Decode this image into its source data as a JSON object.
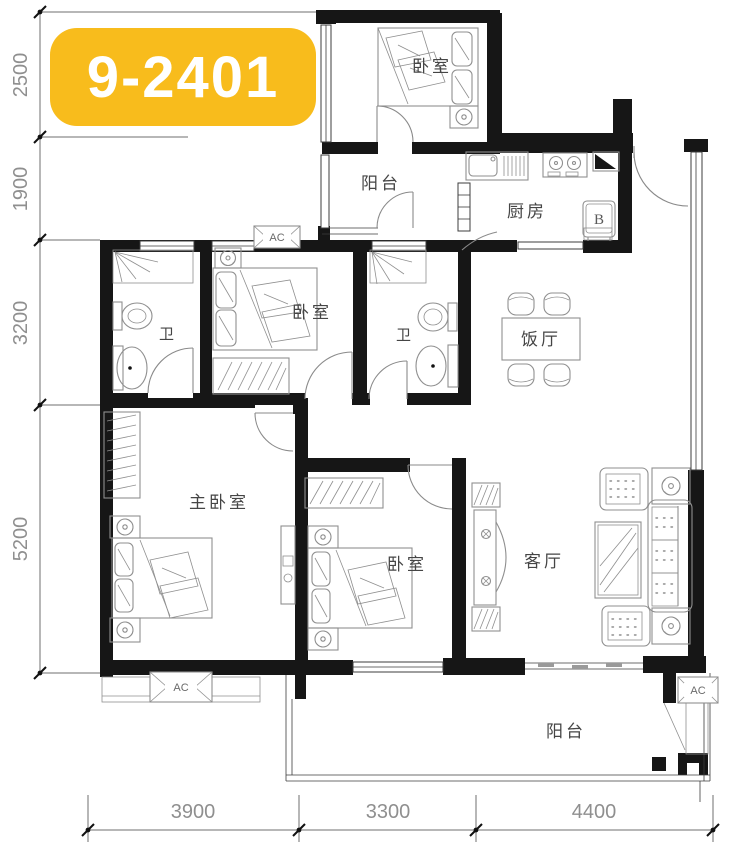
{
  "badge": {
    "label": "9-2401"
  },
  "dimensions": {
    "left": [
      {
        "label": "2500"
      },
      {
        "label": "1900"
      },
      {
        "label": "3200"
      },
      {
        "label": "5200"
      }
    ],
    "bottom": [
      {
        "label": "3900"
      },
      {
        "label": "3300"
      },
      {
        "label": "4400"
      }
    ]
  },
  "rooms": {
    "bedroom_top": {
      "label": "卧室"
    },
    "balcony_top": {
      "label": "阳台"
    },
    "kitchen": {
      "label": "厨房"
    },
    "bath_left": {
      "label": "卫"
    },
    "bedroom_mid": {
      "label": "卧室"
    },
    "bath_right": {
      "label": "卫"
    },
    "dining": {
      "label": "饭厅"
    },
    "master_bedroom": {
      "label": "主卧室"
    },
    "bedroom_lower": {
      "label": "卧室"
    },
    "living": {
      "label": "客厅"
    },
    "balcony_bottom": {
      "label": "阳台"
    }
  },
  "markers": {
    "ac_top": {
      "label": "AC"
    },
    "ac_master": {
      "label": "AC"
    },
    "ac_balcony": {
      "label": "AC"
    },
    "fridge": {
      "label": "B"
    }
  },
  "colors": {
    "badge_bg": "#F8BC1C",
    "badge_text": "#FFFFFF",
    "wall": "#161616",
    "dimension_text": "#8F8F8F",
    "label_text": "#454545"
  }
}
